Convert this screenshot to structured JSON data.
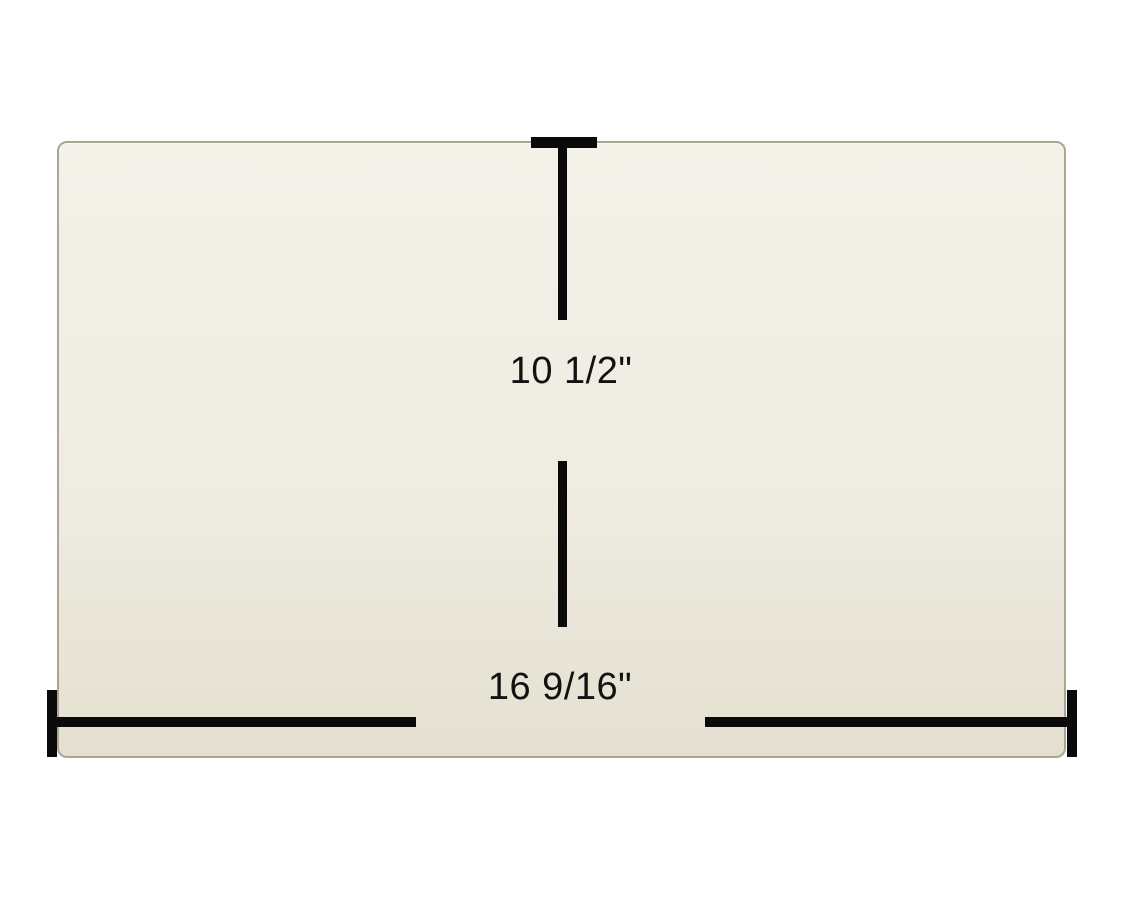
{
  "page": {
    "description": "Product dimension diagram of a rectangular ceramic glass panel on white background"
  },
  "panel": {
    "name": "glass-panel",
    "fill_top_color": "#f3f1e8",
    "fill_bottom_color": "#e4e0d1",
    "border_color": "#aba694"
  },
  "dimensions": {
    "height": {
      "label": "10 1/2\""
    },
    "width": {
      "label": "16 9/16\""
    }
  },
  "style": {
    "dimension_line_color": "#0a0a0a",
    "label_text_color": "#121212",
    "background_color": "#ffffff"
  }
}
